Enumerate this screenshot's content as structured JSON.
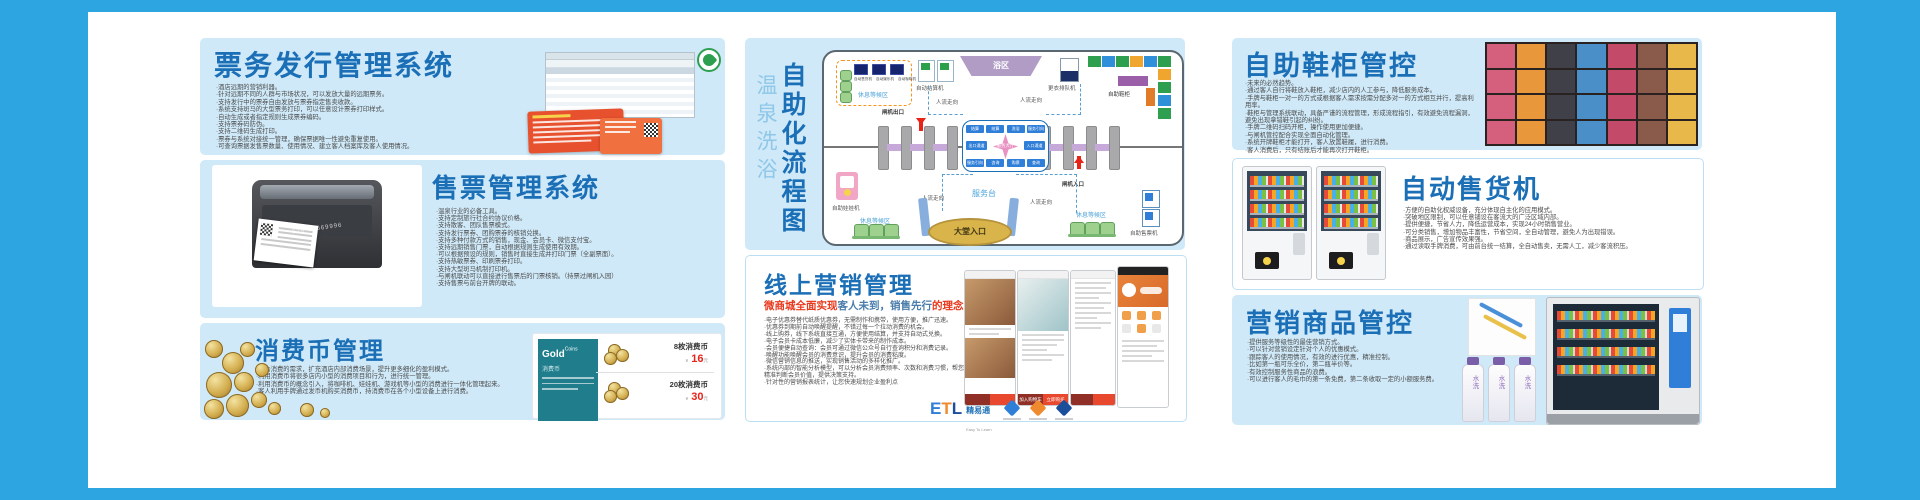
{
  "panels": {
    "ticketing": {
      "title": "票务发行管理系统",
      "bullets": [
        "·酒店远期的营销利器。",
        "·针对远期不同的人群与市场状况，可以发放大量的远期票务。",
        "·支持发行中的票券自由发放与票券指定售卖收款。",
        "·系统支持斑马的大型票务打印，可以任意设计票券打印样式。",
        "·自动生成或者指定规则生成票券编码。",
        "·支持票券码防伪。",
        "·支持二维码生成打印。",
        "·票券与系统对接统一管理，确保票据唯一性避免重复使用。",
        "·可查询票据发售票数量、使用情况、建立客人档案库及客人使用情况。"
      ]
    },
    "sales": {
      "title": "售票管理系统",
      "photo_watermark": "024-85669996",
      "bullets": [
        "·温泉行业的必备工具。",
        "·支持定制旅行社合约协议价格。",
        "·支持散客、团队售票模式。",
        "·支持发行票券、团购票券的核销兑换。",
        "·支持多种付款方式的销售，现金、会员卡、微信支付宝。",
        "·支持远期销售门票，自动根据规则生成使用有效期。",
        "·可以根据预设的规则，销售时直接生成并打印门票（全副票面）。",
        "·支持热敏票券、印刷票券打印。",
        "·支持大型斑马机制打印机。",
        "·与闸机联动可以直接进行售票后的门票核销。（持票过闸机入园）",
        "·支持售票与前台开牌的联动。"
      ]
    },
    "coins": {
      "title": "消费币管理",
      "bullets": [
        "·结合消费的需求，扩充酒店内部消费场景，提升更多细化的盈利模式。",
        "·利用消费币将很多店内小型的消费项目和行为，进行统一管理。",
        "·利用消费币的概念引入，将咖啡机、娃娃机、游戏机等小型的消费进行一体化管理起来。",
        "·客人利用手牌通过发币机购买消费币，持消费币在各个小型设备上进行消费。"
      ],
      "card": {
        "brand": "Gold",
        "brand_sub": "Coins",
        "brand_label": "消费币",
        "items": [
          {
            "name": "8枚消费币",
            "currency": "¥",
            "price": "16",
            "suffix": "元"
          },
          {
            "name": "20枚消费币",
            "currency": "¥",
            "price": "30",
            "suffix": "元"
          }
        ]
      }
    },
    "flow": {
      "title_light": "温泉洗浴",
      "title_bold": "自助化流程图",
      "rest_area_label": "休息等候区",
      "mini_machines": [
        "自动售货机",
        "自动娱乐机",
        "自动咖啡机"
      ],
      "settle_machine": "自动结算机",
      "bath_zone": "浴区",
      "queue_machine": "更衣排队机",
      "shoe_locker": "自助鞋柜",
      "gate_exit": "闸机出口",
      "gate_entry": "闸机入口",
      "flow_direction": "人流走向",
      "service_desk": "服务台",
      "lobby_entrance": "大堂入口",
      "claw_machine": "自助娃娃机",
      "ticket_machine": "自助售票机",
      "hub_center": "服务大厅",
      "hub_top": [
        "结算",
        "结算",
        "洗浴",
        "服务引向"
      ],
      "hub_left": "出口通道",
      "hub_right": "入口通道",
      "hub_bottom": [
        "服务引向",
        "咨询",
        "购票",
        "查询"
      ]
    },
    "online": {
      "title": "线上营销管理",
      "subtitle_1": "微商城全面实现",
      "subtitle_2": "客人未到，销售先行",
      "subtitle_3": "的理念",
      "bullets": [
        "·电子优惠券替代纸质优惠券，无需制作和携带，使用方便，推广迅速。",
        "·优惠券到期前自动唤醒提醒，不错过每一个拉动消费的机会。",
        "·线上购券，线下系统直接互通，方便使用结算，并支持自动式兑换。",
        "·电子会员卡成本低廉，减少了实体卡带来的制作成本。",
        "·会员便捷自动查询：会员可通过微信公众号自行查询积分和消费记录。",
        "·唤醒功能唤醒会员的消费意识，提升会员的消费粘度。",
        "·微信营销信息的推送，实现销售活动的多样化推广。",
        "·系统内部的智能分析模型，可以分析会员消费频率、次数和消费习惯，帮您精准判断会员价值，提供决策支持。",
        "·针对性的营销报表统计，让您快速规划企业盈利点"
      ],
      "phone_buttons": [
        "加入购物车",
        "立即购买"
      ],
      "logo": {
        "e": "E",
        "t": "T",
        "l": "L",
        "cn": "精易通",
        "tagline": "Easy To Learn"
      }
    },
    "shoes": {
      "title": "自助鞋柜管控",
      "bullets": [
        "·未来的必然趋势。",
        "·通过客人自行将鞋放入鞋柜，减少店内的人工参与，降低服务成本。",
        "·手牌与鞋柜一对一的方式或根据客人需求按需分配多对一的方式相互并行，提高利用率。",
        "·鞋柜与管理系统联动，具备严谨的流程管理，形成流程指引，有效避免流程漏洞，避免出现拿错鞋引起的纠纷。",
        "·手牌二维码扫码开柜，操作使用更加便捷。",
        "·与闸机管控配合实现全面自动化管理。",
        "·系统开牌鞋柜才能打开，客人放置鞋履，进行消费。",
        "·客人消费后，只有结账后才能再次打开鞋柜。"
      ]
    },
    "vending": {
      "title": "自动售货机",
      "bullets": [
        "·方便的自助化权威设备，充分体现自主化的应用模式。",
        "·突破地区限制，可以任意铺设在客流大的广泛区域内部。",
        "·提供便捷，节省人力，降低运营成本，实现24小时销售营业。",
        "·可分类销售，增加物品丰富性，节省空间，全自动管理，避免人为出现错误。",
        "·商品展示，广告宣传效果强。",
        "·通过读取手牌消费，可由前台统一结算，全自动售卖，无需人工，减少客流积压。"
      ]
    },
    "goods": {
      "title": "营销商品管控",
      "bullets": [
        "·提供服务等级性的最佳营销方式。",
        "·可以针对营销设定针对个人的优惠模式。",
        "·跟踪客人的使用情况，有效的进行优惠，精准控制。",
        "·比如第一瓶可乐全价，第二瓶半价等。",
        "·有效控制服务性商品的浪费。",
        "·可以进行客人的毛巾的第一条免费，第二条收取一定的小额服务费。"
      ],
      "bottle_label": "水洗"
    }
  }
}
